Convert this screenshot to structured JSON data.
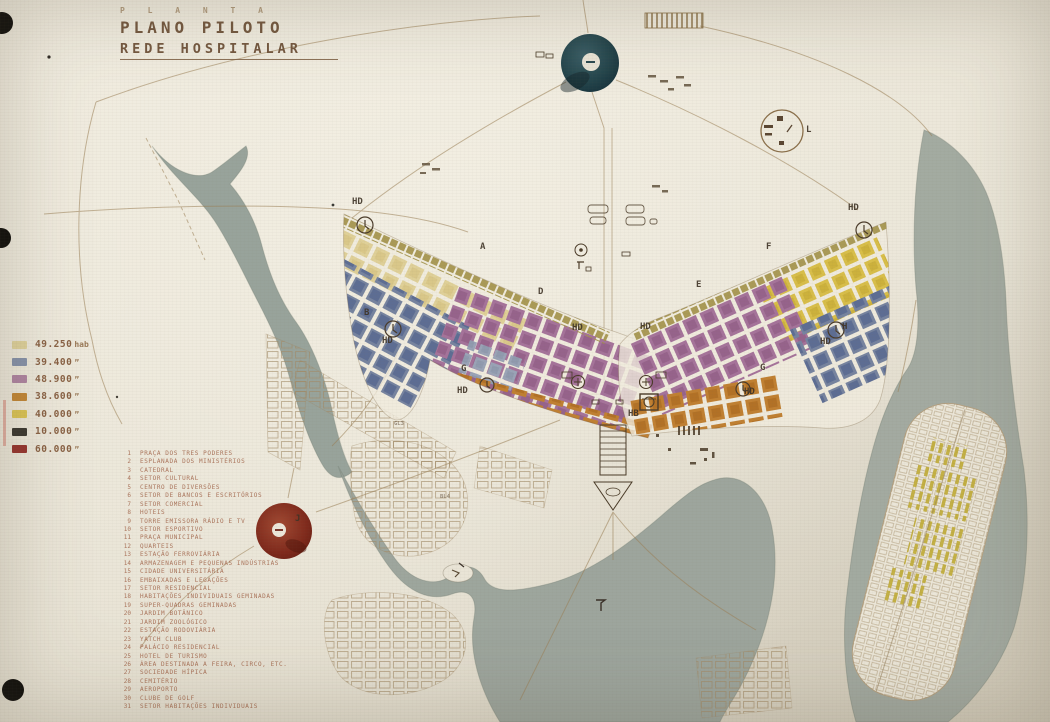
{
  "slide": {
    "kicker": "P L A N T A",
    "title": "PLANO PILOTO",
    "subtitle": "REDE HOSPITALAR"
  },
  "legend": {
    "items": [
      {
        "value": "49.250",
        "suffix": "hab",
        "color": "#ddcf96"
      },
      {
        "value": "39.400",
        "suffix": "”",
        "color": "#7d8aa6"
      },
      {
        "value": "48.900",
        "suffix": "”",
        "color": "#a97b9d"
      },
      {
        "value": "38.600",
        "suffix": "”",
        "color": "#bf7e28"
      },
      {
        "value": "40.000",
        "suffix": "”",
        "color": "#d9c04a"
      },
      {
        "value": "10.000",
        "suffix": "”",
        "color": "#2a2722"
      },
      {
        "value": "60.000",
        "suffix": "”",
        "color": "#8e2420"
      }
    ]
  },
  "index_list": {
    "items": [
      {
        "num": "1",
        "label": "PRAÇA DOS TRES PODERES"
      },
      {
        "num": "2",
        "label": "ESPLANADA DOS MINISTÉRIOS"
      },
      {
        "num": "3",
        "label": "CATEDRAL"
      },
      {
        "num": "4",
        "label": "SETOR CULTURAL"
      },
      {
        "num": "5",
        "label": "CENTRO DE DIVERSÕES"
      },
      {
        "num": "6",
        "label": "SETOR DE BANCOS E ESCRITÓRIOS"
      },
      {
        "num": "7",
        "label": "SETOR COMERCIAL"
      },
      {
        "num": "8",
        "label": "HOTEIS"
      },
      {
        "num": "9",
        "label": "TORRE EMISSORA RÁDIO E TV"
      },
      {
        "num": "10",
        "label": "SETOR ESPORTIVO"
      },
      {
        "num": "11",
        "label": "PRAÇA MUNICIPAL"
      },
      {
        "num": "12",
        "label": "QUARTEIS"
      },
      {
        "num": "13",
        "label": "ESTAÇÃO FERROVIÁRIA"
      },
      {
        "num": "14",
        "label": "ARMAZENAGEM E PEQUENAS INDÚSTRIAS"
      },
      {
        "num": "15",
        "label": "CIDADE UNIVERSITÁRIA"
      },
      {
        "num": "16",
        "label": "EMBAIXADAS E LEGAÇÕES"
      },
      {
        "num": "17",
        "label": "SETOR RESIDENCIAL"
      },
      {
        "num": "18",
        "label": "HABITAÇÕES INDIVIDUAIS GEMINADAS"
      },
      {
        "num": "19",
        "label": "SUPER-QUADRAS GEMINADAS"
      },
      {
        "num": "20",
        "label": "JARDIM BOTÂNICO"
      },
      {
        "num": "21",
        "label": "JARDIM ZOOLÓGICO"
      },
      {
        "num": "22",
        "label": "ESTAÇÃO RODOVIÁRIA"
      },
      {
        "num": "23",
        "label": "YATCH CLUB"
      },
      {
        "num": "24",
        "label": "PALÁCIO RESIDENCIAL"
      },
      {
        "num": "25",
        "label": "HOTEL DE TURISMO"
      },
      {
        "num": "26",
        "label": "ÁREA DESTINADA A FEIRA, CIRCO, ETC."
      },
      {
        "num": "27",
        "label": "SOCIEDADE HÍPICA"
      },
      {
        "num": "28",
        "label": "CEMITÉRIO"
      },
      {
        "num": "29",
        "label": "AEROPORTO"
      },
      {
        "num": "30",
        "label": "CLUBE DE GOLF"
      },
      {
        "num": "31",
        "label": "SETOR HABITAÇÕES INDIVIDUAIS"
      }
    ]
  },
  "map_labels": [
    {
      "text": "HD"
    },
    {
      "text": "A"
    },
    {
      "text": "D"
    },
    {
      "text": "B"
    },
    {
      "text": "HD"
    },
    {
      "text": "G"
    },
    {
      "text": "HD"
    },
    {
      "text": "HD"
    },
    {
      "text": "HD"
    },
    {
      "text": "HB"
    },
    {
      "text": "E"
    },
    {
      "text": "F"
    },
    {
      "text": "G"
    },
    {
      "text": "HD"
    },
    {
      "text": "H"
    },
    {
      "text": "HD"
    },
    {
      "text": "HD"
    },
    {
      "text": "L"
    },
    {
      "text": "J"
    },
    {
      "text": "GL3"
    },
    {
      "text": "BL4"
    }
  ]
}
